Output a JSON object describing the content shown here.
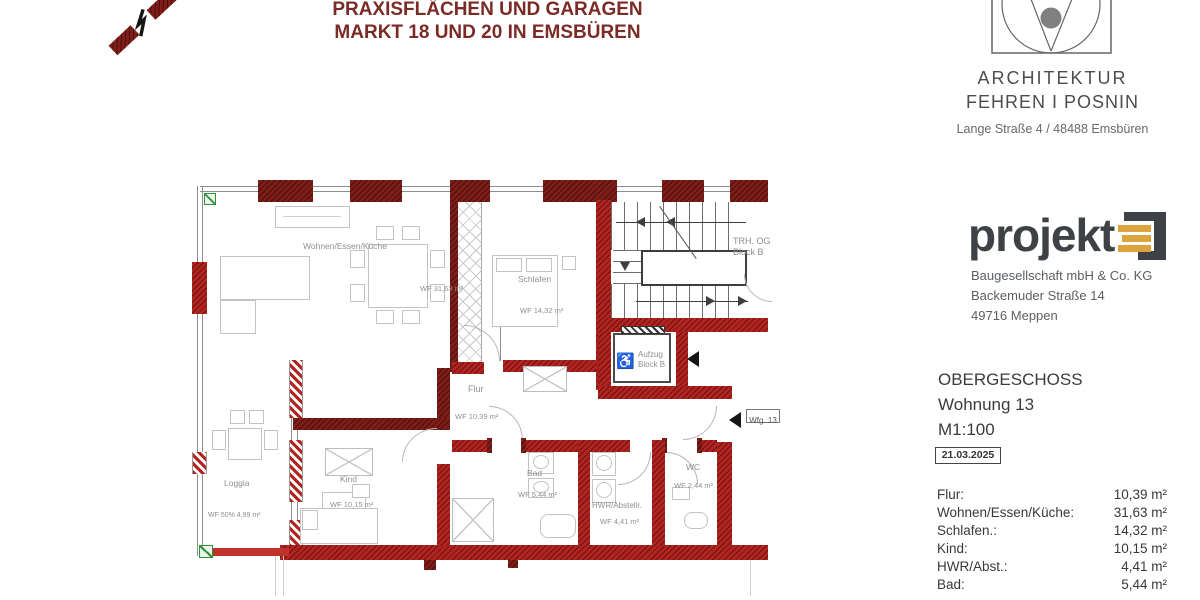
{
  "header": {
    "title_line1": "PRAXISFLÄCHEN UND GARAGEN",
    "title_line2": "MARKT 18 UND 20 IN EMSBÜREN"
  },
  "architect": {
    "line1": "ARCHITEKTUR",
    "line2": "FEHREN I POSNIN",
    "address": "Lange Straße 4 / 48488 Emsbüren"
  },
  "company": {
    "logo_text": "projekt",
    "line1": "Baugesellschaft mbH & Co. KG",
    "line2": "Backemuder Straße 14",
    "line3": "49716 Meppen"
  },
  "drawing_info": {
    "floor": "OBERGESCHOSS",
    "unit": "Wohnung 13",
    "scale": "M1:100",
    "date": "21.03.2025"
  },
  "room_table": {
    "rows": [
      {
        "label": "Flur:",
        "value": "10,39 m²"
      },
      {
        "label": "Wohnen/Essen/Küche:",
        "value": "31,63 m²"
      },
      {
        "label": "Schlafen.:",
        "value": "14,32 m²"
      },
      {
        "label": "Kind:",
        "value": "10,15 m²"
      },
      {
        "label": "HWR/Abst.:",
        "value": "4,41 m²"
      },
      {
        "label": "Bad:",
        "value": "5,44 m²"
      }
    ]
  },
  "plan": {
    "rooms": [
      {
        "name": "Wohnen/Essen/Küche",
        "area": "WF 31,63 m²"
      },
      {
        "name": "Schlafen",
        "area": "WF 14,32 m²"
      },
      {
        "name": "Flur",
        "area": "WF 10,39 m²"
      },
      {
        "name": "Kind",
        "area": "WF 10,15 m²"
      },
      {
        "name": "Bad",
        "area": "WF 5,44 m²"
      },
      {
        "name": "HWR/Abstellr.",
        "area": "WF 4,41 m²"
      },
      {
        "name": "WC",
        "area": "WF 2,44 m²"
      },
      {
        "name": "Loggia",
        "area": "WF 50% 4,99 m²"
      }
    ],
    "stairwell": {
      "line1": "TRH. OG",
      "line2": "Block B"
    },
    "elevator": {
      "line1": "Aufzug",
      "line2": "Block B",
      "wheelchair_icon": "♿"
    },
    "entrance_tag": "Wfg. 13"
  },
  "colors": {
    "wall_red": "#b2241f",
    "wall_dark": "#801d18",
    "title_red": "#7b2b26",
    "logo_orange": "#dda43e",
    "logo_gray": "#3e4247",
    "symbol_green": "#2f8f3a"
  }
}
